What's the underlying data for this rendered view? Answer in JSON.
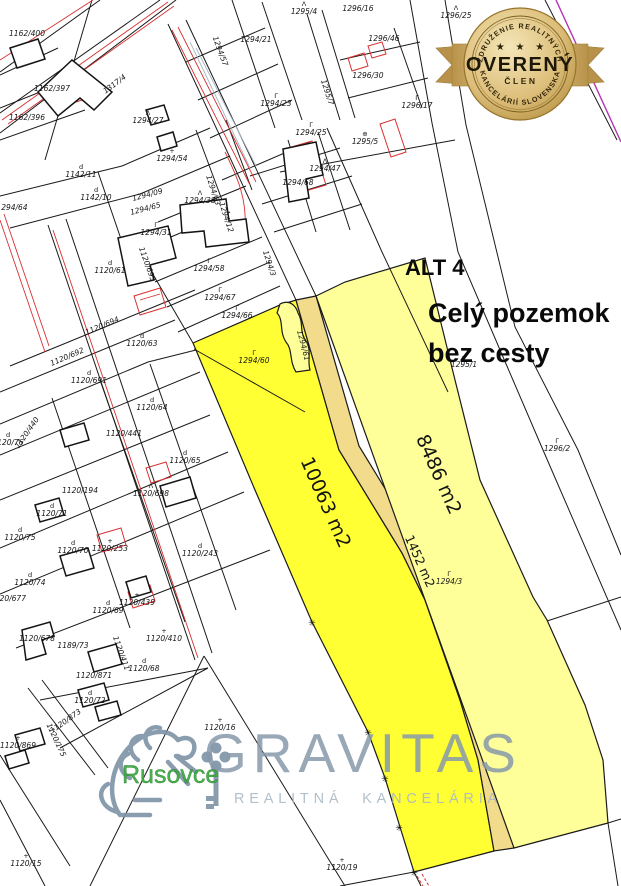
{
  "annotation": {
    "title": "ALT 4",
    "line1": "Celý pozemok",
    "line2": "bez cesty"
  },
  "highlight": {
    "left_parcel_area": "10063 m2",
    "right_parcel_area": "8486 m2",
    "road_area": "1452 m2",
    "colors": {
      "bright": "#FFFF33",
      "light": "#FFFF99",
      "road": "#F2DC8C"
    }
  },
  "badge": {
    "arc_top": "ZDRUŽENIE REALITNÝCH",
    "stars": "★ ★ ★",
    "title": "OVERENÝ",
    "subtitle": "ČLEN",
    "arc_bottom": "KANCELÁRIÍ SLOVENSKA"
  },
  "watermark": {
    "brand": "GRAVITAS",
    "tagline": "REALITNÁ KANCELÁRIA",
    "location": "Rusovce"
  },
  "icons": {
    "boundary_marker": "✳"
  },
  "parcel_labels": [
    {
      "t": "1162/400",
      "x": 27,
      "y": 36
    },
    {
      "t": "1162/397",
      "x": 52,
      "y": 91
    },
    {
      "t": "1162/396",
      "x": 27,
      "y": 120
    },
    {
      "t": "1317/4",
      "x": 116,
      "y": 86,
      "r": -37
    },
    {
      "t": "1294/27",
      "x": 148,
      "y": 123,
      "sym": "Λ"
    },
    {
      "t": "1294/21",
      "x": 256,
      "y": 42
    },
    {
      "t": "1295/4",
      "x": 304,
      "y": 14,
      "sym": "Λ"
    },
    {
      "t": "1296/16",
      "x": 358,
      "y": 11
    },
    {
      "t": "1296/25",
      "x": 456,
      "y": 18,
      "sym": "Λ",
      "s": 6.5
    },
    {
      "t": "1294/57",
      "x": 218,
      "y": 52,
      "r": 70,
      "s": 6.5
    },
    {
      "t": "1296/46",
      "x": 384,
      "y": 41
    },
    {
      "t": "1296/30",
      "x": 368,
      "y": 78
    },
    {
      "t": "1295/7",
      "x": 325,
      "y": 93,
      "r": 72
    },
    {
      "t": "1296/17",
      "x": 417,
      "y": 108,
      "sym": "Γ"
    },
    {
      "t": "1295/5",
      "x": 365,
      "y": 144,
      "sym": "⊕"
    },
    {
      "t": "1294/25",
      "x": 311,
      "y": 135,
      "sym": "Γ"
    },
    {
      "t": "1294/23",
      "x": 276,
      "y": 106,
      "sym": "Γ"
    },
    {
      "t": "1294/54",
      "x": 172,
      "y": 161,
      "sym": "+"
    },
    {
      "t": "1294/47",
      "x": 325,
      "y": 171,
      "sym": "Λ"
    },
    {
      "t": "1294/68",
      "x": 298,
      "y": 185
    },
    {
      "t": "1294/38",
      "x": 200,
      "y": 203,
      "sym": "Λ"
    },
    {
      "t": "1142/11",
      "x": 81,
      "y": 177,
      "sym": "d"
    },
    {
      "t": "1142/10",
      "x": 96,
      "y": 200,
      "sym": "d"
    },
    {
      "t": "1294/09",
      "x": 148,
      "y": 197,
      "r": -15,
      "s": 6.5
    },
    {
      "t": "1294/65",
      "x": 146,
      "y": 211,
      "r": -15,
      "s": 6.5
    },
    {
      "t": "1294/64",
      "x": 12,
      "y": 210,
      "s": 6.5
    },
    {
      "t": "1294/31",
      "x": 156,
      "y": 235,
      "sym": "Γ"
    },
    {
      "t": "1294/58",
      "x": 209,
      "y": 271,
      "sym": "Γ"
    },
    {
      "t": "1294/67",
      "x": 220,
      "y": 300,
      "sym": "Γ"
    },
    {
      "t": "1294/66",
      "x": 237,
      "y": 318,
      "sym": "Γ"
    },
    {
      "t": "1294/12",
      "x": 224,
      "y": 218,
      "r": 72
    },
    {
      "t": "1294/63",
      "x": 211,
      "y": 191,
      "r": 72
    },
    {
      "t": "1294/3",
      "x": 267,
      "y": 264,
      "r": 72
    },
    {
      "t": "1120/693",
      "x": 145,
      "y": 265,
      "r": 70
    },
    {
      "t": "1120/61",
      "x": 110,
      "y": 273,
      "sym": "d"
    },
    {
      "t": "1294/60",
      "x": 254,
      "y": 363,
      "sym": "Γ"
    },
    {
      "t": "1294/61",
      "x": 301,
      "y": 346,
      "r": 75,
      "s": 6.5
    },
    {
      "t": "1120/694",
      "x": 103,
      "y": 328,
      "r": -23
    },
    {
      "t": "1120/692",
      "x": 68,
      "y": 359,
      "r": -23
    },
    {
      "t": "1120/63",
      "x": 142,
      "y": 346,
      "sym": "d"
    },
    {
      "t": "1120/691",
      "x": 89,
      "y": 383,
      "sym": "d"
    },
    {
      "t": "1120/64",
      "x": 152,
      "y": 410,
      "sym": "d"
    },
    {
      "t": "1120/441",
      "x": 124,
      "y": 436
    },
    {
      "t": "1120/440",
      "x": 29,
      "y": 434,
      "r": -55,
      "s": 6.5
    },
    {
      "t": "1120/76",
      "x": 8,
      "y": 445,
      "sym": "d"
    },
    {
      "t": "1120/194",
      "x": 80,
      "y": 493
    },
    {
      "t": "1120/65",
      "x": 185,
      "y": 463,
      "sym": "d"
    },
    {
      "t": "1120/698",
      "x": 151,
      "y": 496,
      "sym": "Λ"
    },
    {
      "t": "1120/71",
      "x": 52,
      "y": 516,
      "sym": "d"
    },
    {
      "t": "1120/75",
      "x": 20,
      "y": 540,
      "sym": "d"
    },
    {
      "t": "1120/70",
      "x": 73,
      "y": 553,
      "sym": "d"
    },
    {
      "t": "1120/253",
      "x": 110,
      "y": 551,
      "sym": "+"
    },
    {
      "t": "1120/243",
      "x": 200,
      "y": 556,
      "sym": "d"
    },
    {
      "t": "1120/74",
      "x": 30,
      "y": 585,
      "sym": "d"
    },
    {
      "t": "1120/439",
      "x": 137,
      "y": 605,
      "sym": "+"
    },
    {
      "t": "1120/69",
      "x": 108,
      "y": 613,
      "sym": "d"
    },
    {
      "t": "1120/410",
      "x": 164,
      "y": 641,
      "sym": "+"
    },
    {
      "t": "1120/411",
      "x": 119,
      "y": 654,
      "r": 70
    },
    {
      "t": "1120/68",
      "x": 144,
      "y": 671,
      "sym": "d"
    },
    {
      "t": "1120/677",
      "x": 8,
      "y": 601,
      "s": 6.5
    },
    {
      "t": "1120/678",
      "x": 37,
      "y": 641,
      "s": 6.5
    },
    {
      "t": "1189/73",
      "x": 73,
      "y": 648,
      "s": 6.5
    },
    {
      "t": "1120/871",
      "x": 94,
      "y": 678
    },
    {
      "t": "1120/72",
      "x": 90,
      "y": 703,
      "sym": "d"
    },
    {
      "t": "1120/873",
      "x": 67,
      "y": 723,
      "r": -35,
      "s": 6.5
    },
    {
      "t": "1120/869",
      "x": 18,
      "y": 748,
      "sym": "+"
    },
    {
      "t": "1120/175",
      "x": 54,
      "y": 741,
      "r": 65
    },
    {
      "t": "1120/15",
      "x": 26,
      "y": 866,
      "sym": "+"
    },
    {
      "t": "1120/16",
      "x": 220,
      "y": 730,
      "sym": "+"
    },
    {
      "t": "1120/19",
      "x": 342,
      "y": 870,
      "sym": "+"
    },
    {
      "t": "1295/1",
      "x": 464,
      "y": 367,
      "sym": "+",
      "s": 7
    },
    {
      "t": "1296/2",
      "x": 557,
      "y": 451,
      "sym": "Γ"
    },
    {
      "t": "1294/3",
      "x": 449,
      "y": 584,
      "sym": "Γ",
      "s": 7
    }
  ]
}
